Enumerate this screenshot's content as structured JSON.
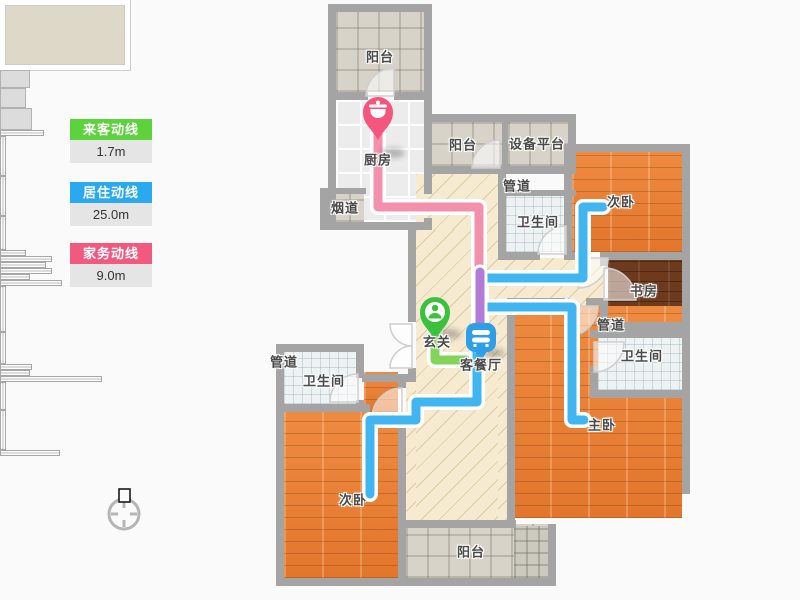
{
  "legend": {
    "items": [
      {
        "id": "guest",
        "label": "来客动线",
        "value": "1.7m",
        "color": "#5cd23c"
      },
      {
        "id": "living",
        "label": "居住动线",
        "value": "25.0m",
        "color": "#29a9f0"
      },
      {
        "id": "chore",
        "label": "家务动线",
        "value": "9.0m",
        "color": "#f2597f"
      }
    ]
  },
  "rooms": [
    {
      "id": "balcony-top",
      "label": "阳台"
    },
    {
      "id": "kitchen",
      "label": "厨房"
    },
    {
      "id": "flue",
      "label": "烟道"
    },
    {
      "id": "balcony-mid",
      "label": "阳台"
    },
    {
      "id": "equipment-platform",
      "label": "设备平台"
    },
    {
      "id": "duct-top",
      "label": "管道"
    },
    {
      "id": "bath-top",
      "label": "卫生间"
    },
    {
      "id": "bedroom-2-right",
      "label": "次卧"
    },
    {
      "id": "study",
      "label": "书房"
    },
    {
      "id": "duct-right",
      "label": "管道"
    },
    {
      "id": "bath-right",
      "label": "卫生间"
    },
    {
      "id": "entry",
      "label": "玄关"
    },
    {
      "id": "living-dining",
      "label": "客餐厅"
    },
    {
      "id": "master-bedroom",
      "label": "主卧"
    },
    {
      "id": "duct-left",
      "label": "管道"
    },
    {
      "id": "bath-left",
      "label": "卫生间"
    },
    {
      "id": "bedroom-2-left",
      "label": "次卧"
    },
    {
      "id": "balcony-bottom",
      "label": "阳台"
    }
  ],
  "pins": [
    {
      "id": "kitchen-pin",
      "room": "厨房",
      "icon": "pot-icon",
      "color": "#f4567d"
    },
    {
      "id": "entry-pin",
      "room": "玄关",
      "icon": "person-icon",
      "color": "#3bc13b"
    },
    {
      "id": "living-pin",
      "room": "客餐厅",
      "icon": "sofa-icon",
      "color": "#2e9fe6"
    }
  ],
  "routes": [
    {
      "id": "guest-route",
      "legend": "来客动线",
      "length": "1.7m",
      "color": "#82d558"
    },
    {
      "id": "living-route",
      "legend": "居住动线",
      "length": "25.0m",
      "color": "#41b5ef"
    },
    {
      "id": "chore-route",
      "legend": "家务动线",
      "length": "9.0m",
      "color": "#f390ab"
    },
    {
      "id": "route-overlap",
      "legend": "居住+家务重叠",
      "color": "#b27bd8"
    }
  ],
  "icons": {
    "compass": "compass-icon"
  },
  "colors": {
    "legend_green": "#5cd23c",
    "legend_blue": "#29a9f0",
    "legend_pink": "#f2597f",
    "path_green": "#82d558",
    "path_blue": "#41b5ef",
    "path_pink": "#f390ab",
    "path_overlap": "#b27bd8",
    "pin_pink": "#f4567d",
    "pin_green": "#3bc13b",
    "pin_blue": "#2e9fe6",
    "wall": "#a4a4a4",
    "label_text": "#4a4a4a"
  }
}
